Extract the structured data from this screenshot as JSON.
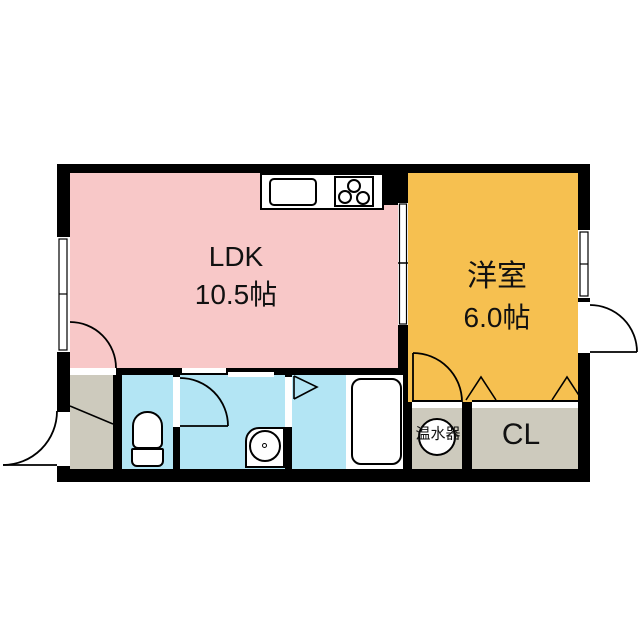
{
  "plan": {
    "type": "japanese-apartment-floor-plan",
    "rooms": {
      "ldk": {
        "name": "LDK",
        "size": "10.5帖"
      },
      "western_room": {
        "name": "洋室",
        "size": "6.0帖"
      },
      "closet": {
        "label": "CL"
      },
      "water_heater": {
        "label": "温水器"
      },
      "entrance": {
        "label": ""
      },
      "toilet": {
        "label": ""
      },
      "washroom": {
        "label": ""
      },
      "bathroom": {
        "label": ""
      }
    },
    "fixtures": [
      "kitchen-counter",
      "kitchen-sink",
      "stove-3-burner",
      "toilet",
      "washbasin",
      "bathtub",
      "water-heater-tank"
    ],
    "symbols": [
      "swing-door-arc",
      "sliding-door",
      "folding-door-triangles",
      "window-double-line",
      "entrance-step-diagonal"
    ]
  },
  "colors": {
    "ldk": "#f8c8c8",
    "western": "#f6c050",
    "wet": "#b3e5f4",
    "service": "#cdcabd",
    "wall": "#000000",
    "fixture": "#ffffff"
  }
}
